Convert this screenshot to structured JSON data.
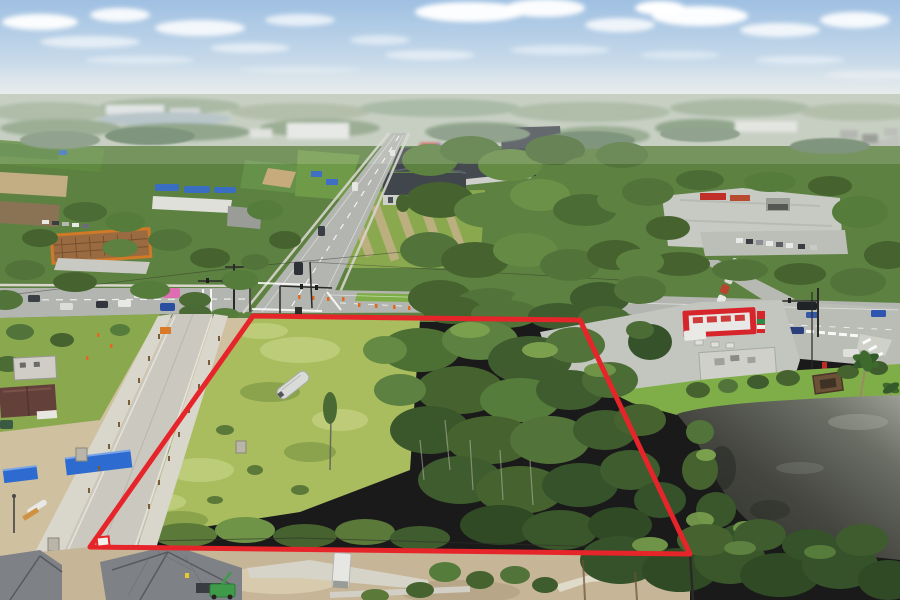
{
  "scene": {
    "type": "aerial-drone-photograph",
    "description": "Aerial drone photo of a vacant, partly wooded land parcel outlined in red at a suburban four-lane intersection; surroundings include a school campus with ball fields, an apartment complex, a gas station with red canopy, a dark retention pond, and new buildings under construction in the foreground.",
    "sky": "hazy light-blue sky with scattered white clouds",
    "no_visible_text": true,
    "features": [
      "school campus and ball fields",
      "apartment complex with dark hip roofs",
      "main road running to vanishing point",
      "signalized intersection with traffic cones",
      "gas station with red canopy and price sign",
      "retention pond with tree reflections",
      "vacant grassy parcel with stored white boat",
      "street under construction with blue fence panels",
      "new metal-roof buildings under construction",
      "distant lake on hazy horizon"
    ]
  },
  "parcel": {
    "outline_points": "253,316 580,320 690,554 90,547",
    "outline_color": "#e6252b",
    "outline_width": "5"
  },
  "colors": {
    "sky_top": "#9fc0e2",
    "haze": "#e9ece9",
    "asphalt": "#b3b5b0",
    "asphalt_light": "#c6c8c2",
    "concrete_new": "#cac8bf",
    "sidewalk": "#d7d5cc",
    "sand": "#cfc0a0",
    "dirt": "#c6b596",
    "grass_bright": "#7fae48",
    "grass_field": "#a9bd5f",
    "grass_patch": "#c3d07f",
    "tree_dark": "#3f5c2e",
    "tree_mid": "#52743a",
    "tree_light": "#6b9148",
    "pond_dark": "#2c2e29",
    "pond_light": "#9b9e95",
    "lake_gray": "#aebdc4",
    "construction_blue": "#2e6bd0",
    "gas_red": "#d6252b",
    "sign_green": "#2e8b46",
    "store_gray": "#cfd0ca",
    "metal_roof": "#7e8286",
    "metal_roof_dark": "#565a5e",
    "apartment_roof": "#41464d",
    "apartment_wall": "#cfd0cb",
    "school_tan": "#c3ad83",
    "canopy_orange": "#d07a28",
    "boat_white": "#d9dbd8",
    "pink_truck": "#df6db2",
    "lift_green": "#3f9a4a",
    "cone_orange": "#e06a20",
    "marker_white": "#f2f0ea",
    "worker_yellow": "#e8c832"
  }
}
